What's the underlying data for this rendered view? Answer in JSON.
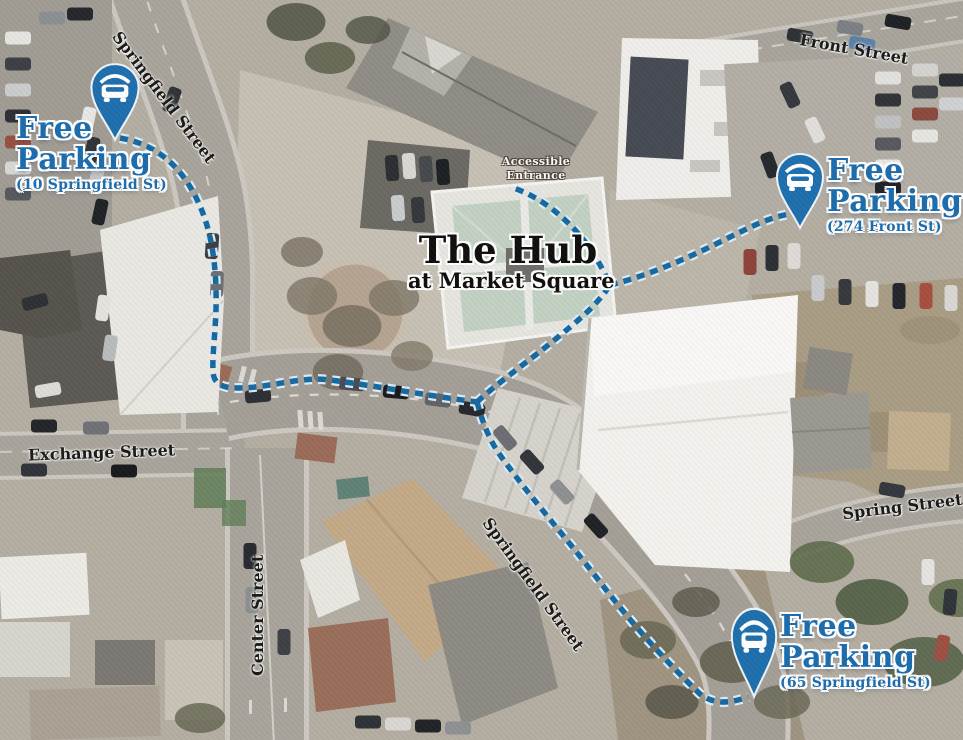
{
  "map": {
    "hub": {
      "title": "The Hub",
      "subtitle": "at Market Square"
    },
    "accessible_entrance": {
      "line1": "Accessible",
      "line2": "Entrance"
    },
    "parking_labels": [
      {
        "id": "nw",
        "line1": "Free",
        "line2": "Parking",
        "address": "(10 Springfield St)",
        "icon": "car-parking-pin-icon"
      },
      {
        "id": "ne",
        "line1": "Free",
        "line2": "Parking",
        "address": "(274 Front St)",
        "icon": "car-parking-pin-icon"
      },
      {
        "id": "se",
        "line1": "Free",
        "line2": "Parking",
        "address": "(65 Springfield St)",
        "icon": "car-parking-pin-icon"
      }
    ],
    "streets": [
      {
        "id": "springfield-nw",
        "name": "Springfield Street"
      },
      {
        "id": "front",
        "name": "Front Street"
      },
      {
        "id": "exchange",
        "name": "Exchange Street"
      },
      {
        "id": "center",
        "name": "Center Street"
      },
      {
        "id": "springfield-center",
        "name": "Springfield Street"
      },
      {
        "id": "spring",
        "name": "Spring Street"
      }
    ],
    "colors": {
      "pin_blue": "#1d6fae",
      "label_blue": "#1a6cae",
      "route_blue": "#15689f",
      "route_halo": "#ddebf6",
      "hub_roof_green": "#c2d1c3"
    }
  }
}
